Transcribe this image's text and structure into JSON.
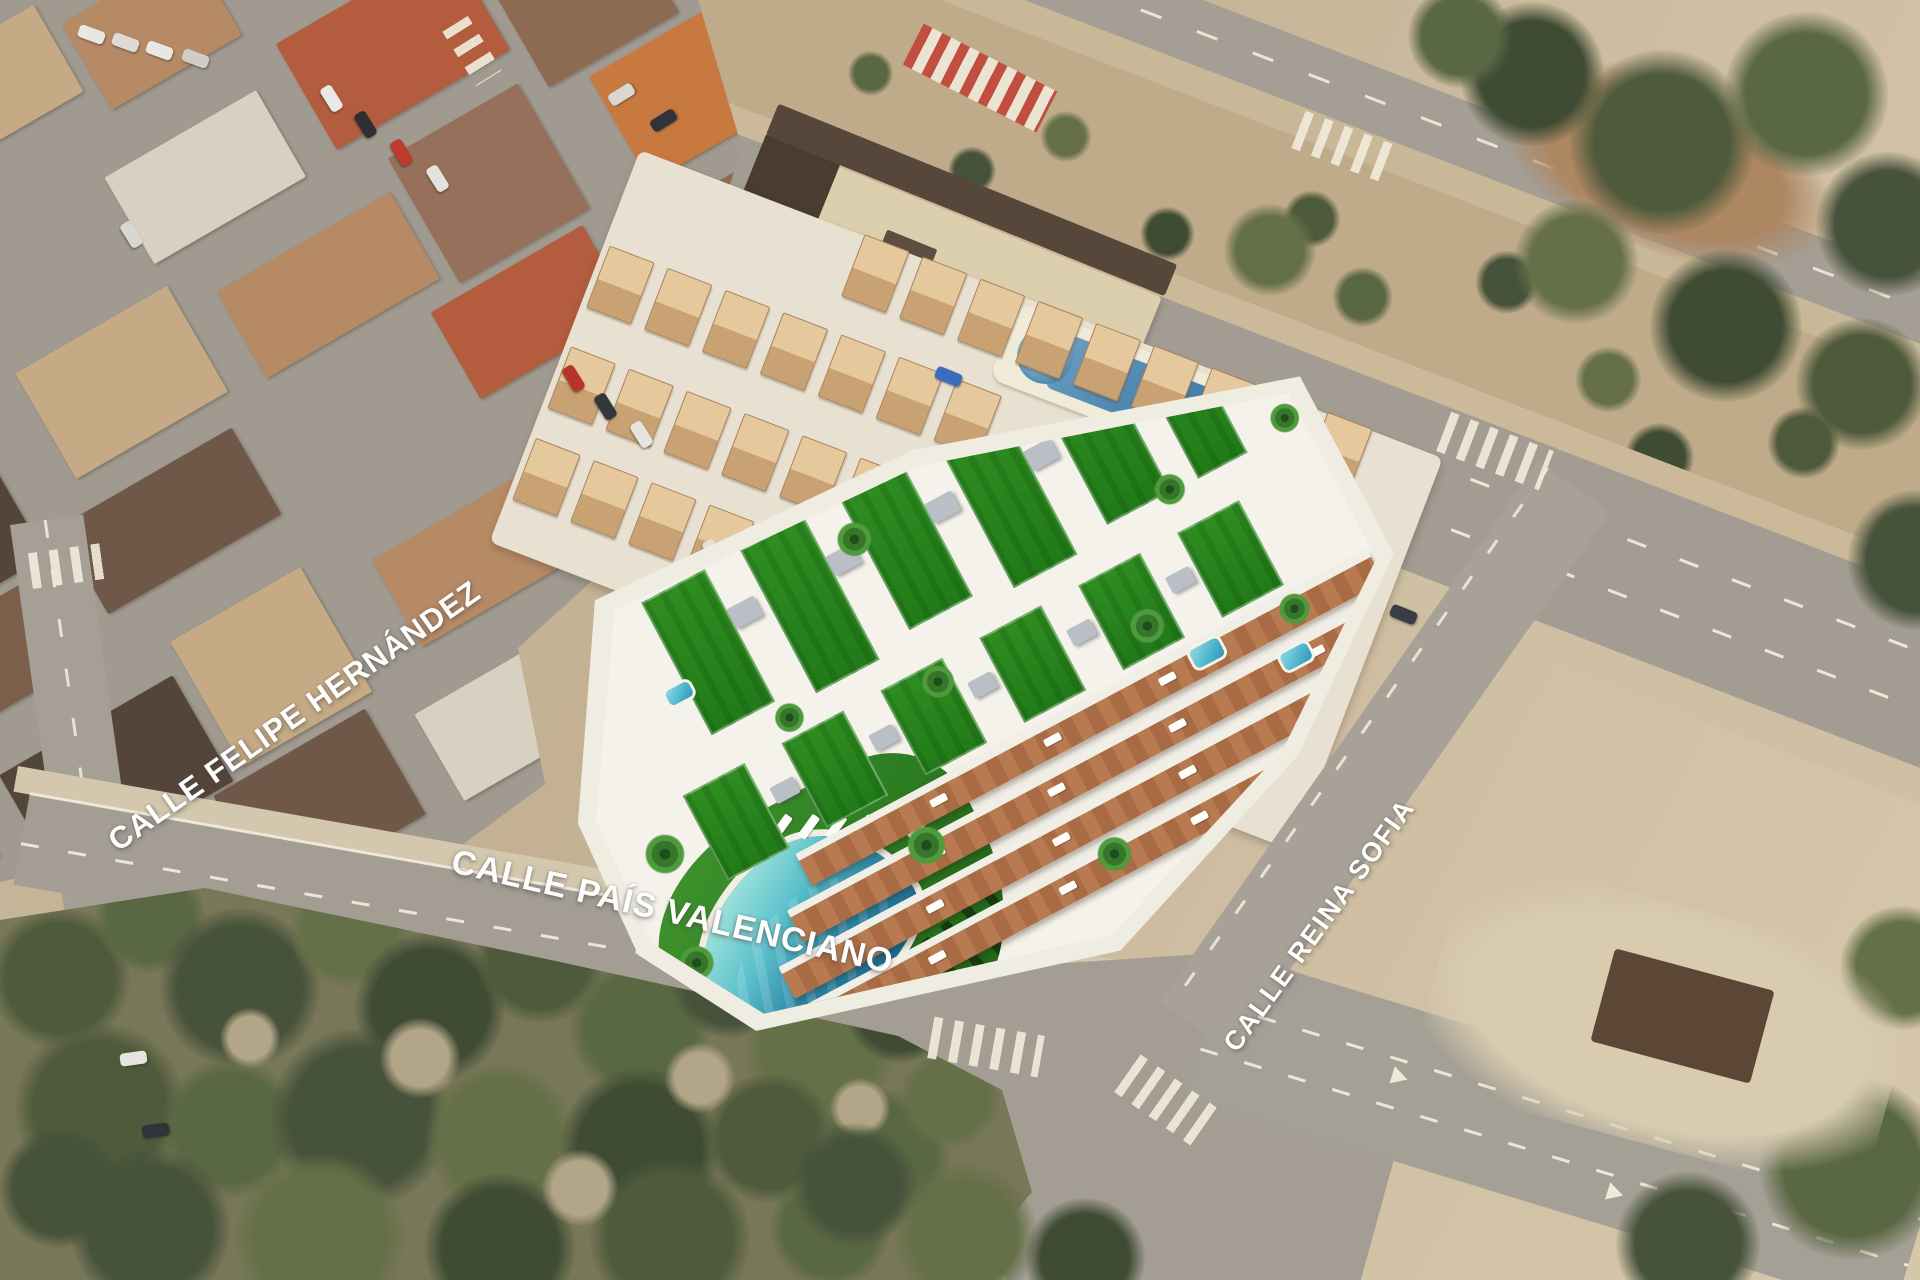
{
  "street_labels": {
    "felipe_hernandez": "CALLE FELIPE HERNÁNDEZ",
    "pais_valenciano": "CALLE PAÍS VALENCIANO",
    "reina_sofia": "CALLE REINA SOFIA"
  },
  "palette": {
    "road_gray": "#a39d94",
    "sand": "#c9b89c",
    "scrub_green": "#57623f",
    "development_lawn": "#2e8b22",
    "terrace_deck": "#b5764e",
    "communal_pool_shallow": "#a9e6dc",
    "communal_pool_deep": "#176d94",
    "neighbor_pool_blue": "#4b86ad",
    "label_white": "#ffffff"
  }
}
